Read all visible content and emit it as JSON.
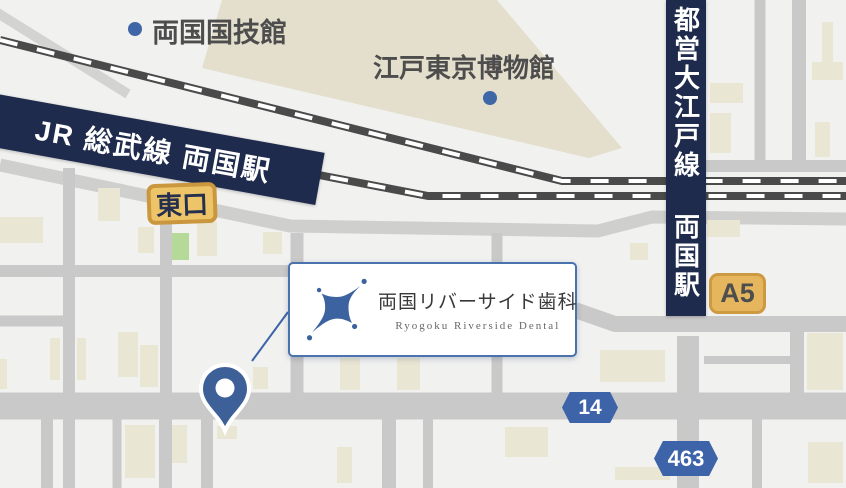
{
  "landmarks": {
    "kokugikan": "両国国技館",
    "museum": "江戸東京博物館"
  },
  "railway": {
    "jr_line_station": "JR 総武線 両国駅",
    "oedo_line_station": "都営大江戸線 両国駅"
  },
  "exits": {
    "east_exit": "東口",
    "a5": "A5"
  },
  "routes": {
    "route14": "14",
    "route463": "463"
  },
  "clinic": {
    "name": "両国リバーサイド歯科",
    "name_en": "Ryogoku Riverside Dental"
  },
  "colors": {
    "background": "#f1f1f0",
    "road_gray": "#c9c9c9",
    "building_beige": "#e9e6d3",
    "museum_beige": "#e3dfcc",
    "green_building": "#b5d998",
    "rail_dark": "#4a4a4a",
    "banner_navy": "#1e2b4c",
    "accent_blue": "#3d63a8",
    "pin_blue": "#3d6098",
    "exit_fill": "#eec468",
    "exit_border": "#ca973e",
    "a5_fill": "#e6b65f",
    "a5_border": "#cd9a41",
    "card_border": "#4a72ad",
    "label_gray": "#4d4d4d"
  }
}
